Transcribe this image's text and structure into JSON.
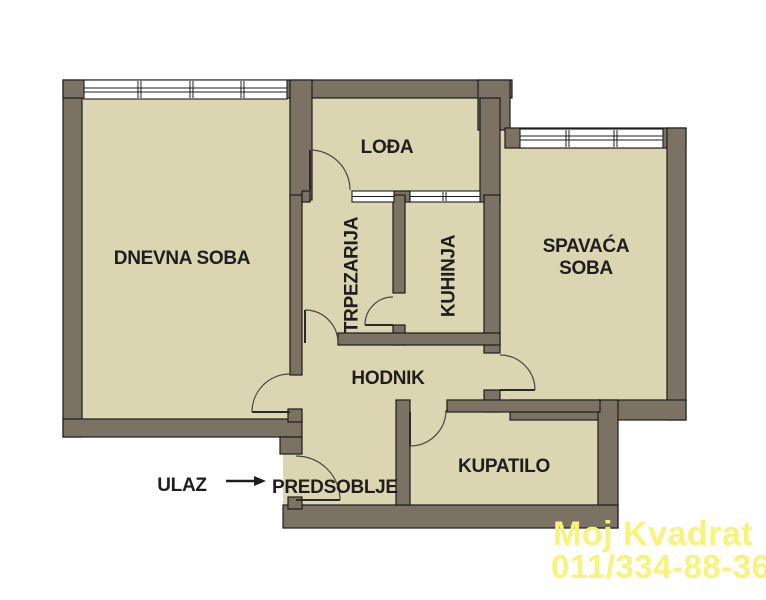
{
  "labels": {
    "dnevna_soba": "DNEVNA SOBA",
    "loda": "LOĐA",
    "trpezarija": "TRPEZARIJA",
    "kuhinja": "KUHINJA",
    "spavaca_line1": "SPAVAĆA",
    "spavaca_line2": "SOBA",
    "hodnik": "HODNIK",
    "kupatilo": "KUPATILO",
    "predsoblje": "PREDSOBLJE",
    "ulaz": "ULAZ"
  },
  "watermark": {
    "line1": "Moj Kvadrat",
    "line2": "011/334-88-36"
  },
  "colors": {
    "floor-color": "#DCD5B2",
    "wall-color": "#7B7264",
    "outline-color": "#1C1C1C",
    "label-color": "#1F1E1C",
    "watermark-color": "#F7F37C"
  }
}
